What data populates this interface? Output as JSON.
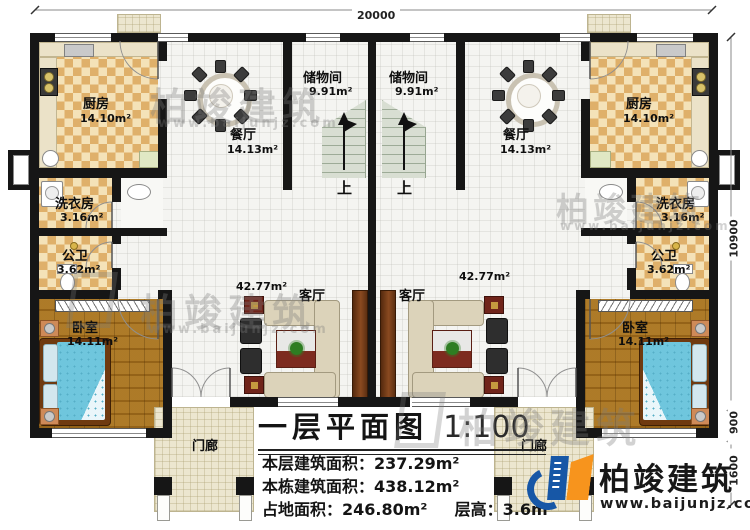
{
  "plan_title": {
    "title": "一层平面图",
    "scale": "1:100"
  },
  "stats": [
    {
      "label": "本层建筑面积：",
      "value": "237.29m²"
    },
    {
      "label": "本栋建筑面积：",
      "value": "438.12m²"
    },
    {
      "label": "占地面积：",
      "value": "246.80m²"
    },
    {
      "label": "层高：",
      "value": "3.6m"
    }
  ],
  "dimensions": {
    "width": "20000",
    "height_main": "10900",
    "height_bay": "900",
    "height_porch": "1600"
  },
  "rooms": {
    "kitchen": {
      "name": "厨房",
      "area": "14.10m²"
    },
    "dining": {
      "name": "餐厅",
      "area": "14.13m²"
    },
    "storage": {
      "name": "储物间",
      "area": "9.91m²"
    },
    "laundry": {
      "name": "洗衣房",
      "area": "3.16m²"
    },
    "bath": {
      "name": "公卫",
      "area": "3.62m²"
    },
    "bedroom": {
      "name": "卧室",
      "area": "14.11m²"
    },
    "living": {
      "name": "客厅",
      "area": "42.77m²"
    },
    "porch": {
      "name": "门廊"
    }
  },
  "stairs": {
    "up": "上"
  },
  "brand": {
    "name": "柏竣建筑",
    "site": "www.baijunjz.com"
  },
  "colors": {
    "logo_blue": "#1757a6",
    "logo_orange": "#f7941d",
    "wall": "#161616"
  }
}
